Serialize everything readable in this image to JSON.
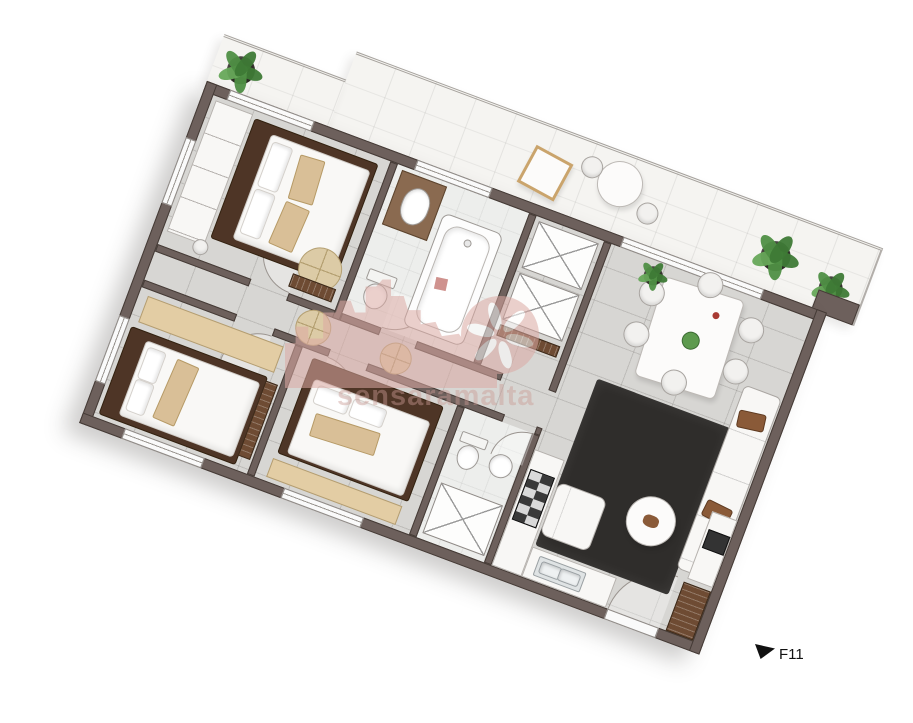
{
  "watermark": {
    "text": "sensaramalta",
    "color": "#c99a94"
  },
  "marker": {
    "label": "F11"
  },
  "palette": {
    "wall": "#6d605c",
    "wall_edge": "#453b36",
    "floor": "#d7d6d3",
    "bath_floor": "#edeeec",
    "terrace_floor": "#f5f4f1",
    "wood_dark": "#4e3526",
    "wood_mid": "#6e4b33",
    "wood_light": "#e3cda4",
    "fabric_white": "#f8f7f5",
    "tan": "#d9bf97",
    "rug_black": "#2f2d2b",
    "plant_green": "#4f8f45",
    "pot_dark": "#2c2824",
    "steel": "#dfe3e4",
    "watermark_pink": "#dcaaa4",
    "watermark_text": "#c99a94",
    "marker_black": "#111111"
  }
}
